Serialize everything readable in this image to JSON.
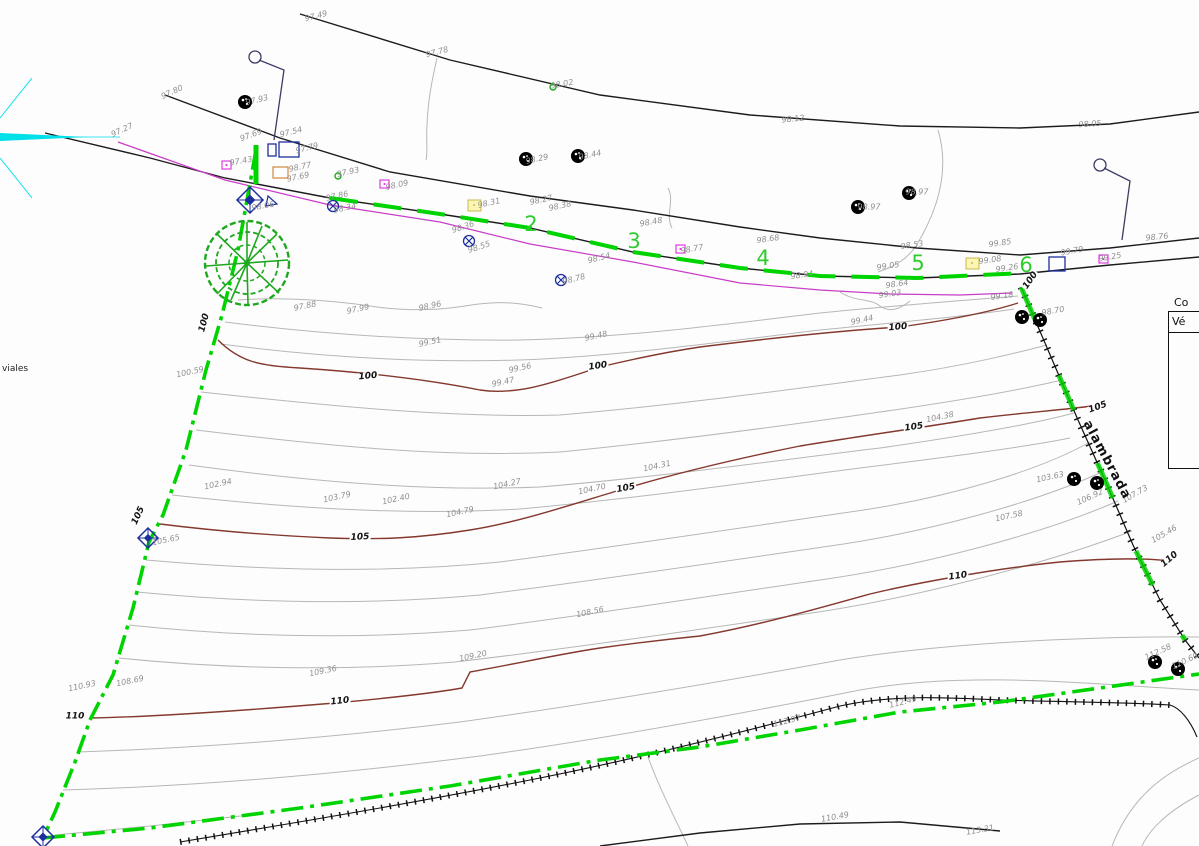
{
  "drawing": {
    "legend_table": {
      "title": "Co",
      "col_header": "Vé"
    },
    "annotations": {
      "viales": "viales",
      "alambrada": "alambrada"
    },
    "station_numbers": [
      {
        "t": "2",
        "x": 531,
        "y": 224,
        "r": 0
      },
      {
        "t": "3",
        "x": 634,
        "y": 241,
        "r": 0
      },
      {
        "t": "4",
        "x": 763,
        "y": 258,
        "r": 0
      },
      {
        "t": "5",
        "x": 918,
        "y": 263,
        "r": 0
      },
      {
        "t": "6",
        "x": 1026,
        "y": 265,
        "r": 0
      }
    ],
    "contour_labels": [
      {
        "t": "100",
        "x": 205,
        "y": 323,
        "r": -75
      },
      {
        "t": "100",
        "x": 368,
        "y": 377,
        "r": -5
      },
      {
        "t": "100",
        "x": 598,
        "y": 367,
        "r": -8
      },
      {
        "t": "100",
        "x": 898,
        "y": 328,
        "r": -5
      },
      {
        "t": "100",
        "x": 1031,
        "y": 281,
        "r": -55
      },
      {
        "t": "105",
        "x": 139,
        "y": 516,
        "r": -65
      },
      {
        "t": "105",
        "x": 360,
        "y": 538,
        "r": -3
      },
      {
        "t": "105",
        "x": 626,
        "y": 489,
        "r": -10
      },
      {
        "t": "105",
        "x": 914,
        "y": 428,
        "r": -8
      },
      {
        "t": "105",
        "x": 1098,
        "y": 408,
        "r": -20
      },
      {
        "t": "110",
        "x": 75,
        "y": 717,
        "r": 0
      },
      {
        "t": "110",
        "x": 340,
        "y": 702,
        "r": -6
      },
      {
        "t": "110",
        "x": 958,
        "y": 577,
        "r": -8
      },
      {
        "t": "110",
        "x": 1170,
        "y": 560,
        "r": -40
      }
    ],
    "spot_elevations": [
      {
        "t": "97.49",
        "x": 316,
        "y": 16,
        "r": -14
      },
      {
        "t": "97.78",
        "x": 437,
        "y": 52,
        "r": -14
      },
      {
        "t": "98.02",
        "x": 562,
        "y": 84,
        "r": -10
      },
      {
        "t": "98.12",
        "x": 793,
        "y": 119,
        "r": -6
      },
      {
        "t": "98.05",
        "x": 1090,
        "y": 124,
        "r": -4
      },
      {
        "t": "98.76",
        "x": 1157,
        "y": 237,
        "r": -6
      },
      {
        "t": "97.80",
        "x": 172,
        "y": 92,
        "r": -25
      },
      {
        "t": "97.93",
        "x": 257,
        "y": 100,
        "r": -14
      },
      {
        "t": "97.27",
        "x": 122,
        "y": 130,
        "r": -25
      },
      {
        "t": "97.69",
        "x": 251,
        "y": 135,
        "r": -20
      },
      {
        "t": "97.54",
        "x": 291,
        "y": 132,
        "r": -14
      },
      {
        "t": "97.79",
        "x": 307,
        "y": 148,
        "r": -14
      },
      {
        "t": "97.43",
        "x": 241,
        "y": 161,
        "r": -10
      },
      {
        "t": "98.77",
        "x": 300,
        "y": 167,
        "r": -12
      },
      {
        "t": "97.69",
        "x": 298,
        "y": 177,
        "r": -12
      },
      {
        "t": "97.93",
        "x": 348,
        "y": 172,
        "r": -12
      },
      {
        "t": "98.09",
        "x": 397,
        "y": 185,
        "r": -12
      },
      {
        "t": "97.86",
        "x": 337,
        "y": 196,
        "r": -12
      },
      {
        "t": "98.34",
        "x": 345,
        "y": 208,
        "r": -12
      },
      {
        "t": "98.06",
        "x": 263,
        "y": 206,
        "r": -10
      },
      {
        "t": "98.29",
        "x": 537,
        "y": 159,
        "r": -12
      },
      {
        "t": "98.44",
        "x": 590,
        "y": 155,
        "r": -12
      },
      {
        "t": "98.31",
        "x": 489,
        "y": 203,
        "r": -12
      },
      {
        "t": "98.27",
        "x": 541,
        "y": 200,
        "r": -12
      },
      {
        "t": "98.38",
        "x": 560,
        "y": 206,
        "r": -12
      },
      {
        "t": "98.36",
        "x": 463,
        "y": 227,
        "r": -18
      },
      {
        "t": "98.55",
        "x": 479,
        "y": 247,
        "r": -18
      },
      {
        "t": "98.54",
        "x": 599,
        "y": 258,
        "r": -14
      },
      {
        "t": "98.48",
        "x": 651,
        "y": 222,
        "r": -10
      },
      {
        "t": "98.78",
        "x": 574,
        "y": 279,
        "r": -14
      },
      {
        "t": "98.77",
        "x": 692,
        "y": 249,
        "r": -10
      },
      {
        "t": "98.68",
        "x": 768,
        "y": 239,
        "r": -8
      },
      {
        "t": "98.97",
        "x": 869,
        "y": 207,
        "r": 0
      },
      {
        "t": "98.97",
        "x": 917,
        "y": 192,
        "r": 0
      },
      {
        "t": "98.53",
        "x": 912,
        "y": 245,
        "r": -8
      },
      {
        "t": "98.94",
        "x": 802,
        "y": 275,
        "r": -8
      },
      {
        "t": "99.05",
        "x": 888,
        "y": 266,
        "r": -8
      },
      {
        "t": "98.64",
        "x": 897,
        "y": 284,
        "r": -8
      },
      {
        "t": "99.03",
        "x": 890,
        "y": 294,
        "r": -8
      },
      {
        "t": "99.85",
        "x": 1000,
        "y": 243,
        "r": -8
      },
      {
        "t": "99.08",
        "x": 990,
        "y": 260,
        "r": -8
      },
      {
        "t": "99.26",
        "x": 1007,
        "y": 268,
        "r": -8
      },
      {
        "t": "99.18",
        "x": 1002,
        "y": 296,
        "r": -8
      },
      {
        "t": "99.79",
        "x": 1072,
        "y": 251,
        "r": -10
      },
      {
        "t": "99.25",
        "x": 1110,
        "y": 257,
        "r": -10
      },
      {
        "t": "98.70",
        "x": 1053,
        "y": 311,
        "r": -10
      },
      {
        "t": "97.88",
        "x": 305,
        "y": 306,
        "r": -12
      },
      {
        "t": "97.99",
        "x": 358,
        "y": 309,
        "r": -12
      },
      {
        "t": "98.96",
        "x": 430,
        "y": 306,
        "r": -12
      },
      {
        "t": "100.59",
        "x": 190,
        "y": 372,
        "r": -12
      },
      {
        "t": "99.51",
        "x": 430,
        "y": 342,
        "r": -12
      },
      {
        "t": "99.48",
        "x": 596,
        "y": 336,
        "r": -12
      },
      {
        "t": "99.44",
        "x": 862,
        "y": 320,
        "r": -12
      },
      {
        "t": "99.56",
        "x": 520,
        "y": 368,
        "r": -12
      },
      {
        "t": "99.47",
        "x": 503,
        "y": 382,
        "r": -12
      },
      {
        "t": "103.79",
        "x": 337,
        "y": 497,
        "r": -12
      },
      {
        "t": "102.40",
        "x": 396,
        "y": 499,
        "r": -12
      },
      {
        "t": "104.79",
        "x": 460,
        "y": 512,
        "r": -12
      },
      {
        "t": "104.27",
        "x": 507,
        "y": 484,
        "r": -12
      },
      {
        "t": "104.70",
        "x": 592,
        "y": 489,
        "r": -12
      },
      {
        "t": "104.31",
        "x": 657,
        "y": 466,
        "r": -12
      },
      {
        "t": "104.38",
        "x": 940,
        "y": 417,
        "r": -12
      },
      {
        "t": "102.94",
        "x": 218,
        "y": 484,
        "r": -12
      },
      {
        "t": "105.65",
        "x": 166,
        "y": 540,
        "r": -12
      },
      {
        "t": "106.92",
        "x": 1090,
        "y": 497,
        "r": -25
      },
      {
        "t": "107.58",
        "x": 1009,
        "y": 516,
        "r": -12
      },
      {
        "t": "107.73",
        "x": 1135,
        "y": 494,
        "r": -30
      },
      {
        "t": "105.46",
        "x": 1164,
        "y": 534,
        "r": -30
      },
      {
        "t": "103.63",
        "x": 1050,
        "y": 477,
        "r": -12
      },
      {
        "t": "108.56",
        "x": 590,
        "y": 612,
        "r": -12
      },
      {
        "t": "109.20",
        "x": 473,
        "y": 656,
        "r": -12
      },
      {
        "t": "109.36",
        "x": 323,
        "y": 671,
        "r": -12
      },
      {
        "t": "108.69",
        "x": 130,
        "y": 681,
        "r": -12
      },
      {
        "t": "110.93",
        "x": 82,
        "y": 686,
        "r": -12
      },
      {
        "t": "112.97",
        "x": 787,
        "y": 721,
        "r": -14
      },
      {
        "t": "112.49",
        "x": 903,
        "y": 702,
        "r": -14
      },
      {
        "t": "110.49",
        "x": 835,
        "y": 817,
        "r": -10
      },
      {
        "t": "113.31",
        "x": 980,
        "y": 830,
        "r": -10
      },
      {
        "t": "112.58",
        "x": 1158,
        "y": 652,
        "r": -25
      },
      {
        "t": "110.69",
        "x": 1185,
        "y": 661,
        "r": -25
      }
    ],
    "symbols": {
      "trees": [
        {
          "x": 245,
          "y": 102
        },
        {
          "x": 526,
          "y": 159
        },
        {
          "x": 578,
          "y": 156
        },
        {
          "x": 858,
          "y": 207
        },
        {
          "x": 909,
          "y": 193
        },
        {
          "x": 1022,
          "y": 317
        },
        {
          "x": 1040,
          "y": 320
        },
        {
          "x": 1074,
          "y": 479
        },
        {
          "x": 1097,
          "y": 483
        },
        {
          "x": 1155,
          "y": 662
        },
        {
          "x": 1178,
          "y": 669
        }
      ],
      "survey_diamonds": [
        {
          "x": 250,
          "y": 200,
          "s": 13
        },
        {
          "x": 148,
          "y": 538,
          "s": 10
        },
        {
          "x": 43,
          "y": 837,
          "s": 11
        }
      ],
      "targets": [
        {
          "x": 333,
          "y": 206
        },
        {
          "x": 469,
          "y": 241
        },
        {
          "x": 561,
          "y": 280
        }
      ],
      "yellow_squares": [
        {
          "x": 468,
          "y": 200
        },
        {
          "x": 966,
          "y": 258
        }
      ],
      "magenta_squares": [
        {
          "x": 222,
          "y": 161
        },
        {
          "x": 380,
          "y": 180
        },
        {
          "x": 676,
          "y": 245
        },
        {
          "x": 1099,
          "y": 255
        }
      ],
      "navy_squares": [
        {
          "x": 279,
          "y": 142,
          "w": 20,
          "h": 15
        },
        {
          "x": 268,
          "y": 144,
          "w": 8,
          "h": 12
        },
        {
          "x": 1049,
          "y": 257,
          "w": 16,
          "h": 14
        }
      ],
      "orange_squares": [
        {
          "x": 273,
          "y": 167,
          "w": 15,
          "h": 11
        }
      ],
      "lamp_posts": [
        {
          "hx": 255,
          "hy": 57,
          "ex": 284,
          "ey": 70,
          "bx": 274,
          "by": 140
        },
        {
          "hx": 1100,
          "hy": 165,
          "ex": 1130,
          "ey": 181,
          "bx": 1122,
          "by": 240
        }
      ],
      "green_circles": [
        {
          "x": 338,
          "y": 176
        },
        {
          "x": 553,
          "y": 87
        }
      ]
    },
    "colors": {
      "boundary_green": "#00d400",
      "tree_green": "#1fa81f",
      "index_contour": "#84382e",
      "contour_gray": "#b7b7b7",
      "road_black": "#1c1c1c",
      "utility_magenta": "#c83cc8",
      "survey_navy": "#1d2f9e",
      "north_cyan": "#00e0e8",
      "station_green": "#2fcc2f",
      "spot_gray": "#8f8f8f",
      "yellow_fill": "#fbf6b4",
      "yellow_border": "#c9bb4e",
      "orange_border": "#cf8a3e",
      "magenta_square": "#e23ce2"
    }
  }
}
